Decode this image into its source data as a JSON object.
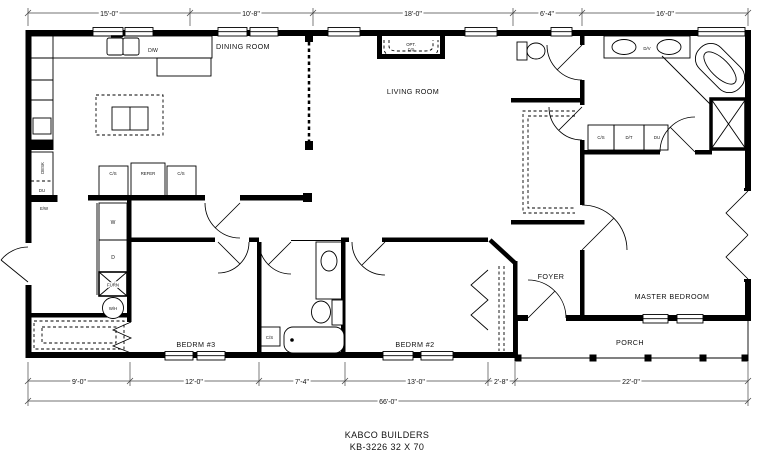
{
  "plan": {
    "title_line1": "KABCO BUILDERS",
    "title_line2": "KB-3226 32 X 70"
  },
  "rooms": {
    "dining": "DINING ROOM",
    "living": "LIVING ROOM",
    "master_bedroom": "MASTER BEDROOM",
    "foyer": "FOYER",
    "porch": "PORCH",
    "bedroom3": "BEDRM #3",
    "bedroom2": "BEDRM #2"
  },
  "fixtures": {
    "dishwasher": "D/W",
    "refrigerator": "REFER",
    "cabinet_cs": "C/S",
    "opt_line1": "OPT.",
    "opt_line2": "F/P",
    "desk": "DESK",
    "du": "DU",
    "ew": "E/W",
    "washer": "W",
    "dryer": "D",
    "furnace": "FURN",
    "water_heater": "W/H",
    "double_vanity": "D/V",
    "dressing_table": "D/T"
  },
  "dimensions": {
    "top": [
      "15'-0\"",
      "10'-8\"",
      "18'-0\"",
      "6'-4\"",
      "16'-0\""
    ],
    "bottom": [
      "9'-0\"",
      "12'-0\"",
      "7'-4\"",
      "13'-0\"",
      "2'-8\"",
      "22'-0\""
    ],
    "overall": "66'-0\""
  },
  "colors": {
    "wall": "#000000",
    "line": "#444444",
    "bg": "#ffffff"
  }
}
